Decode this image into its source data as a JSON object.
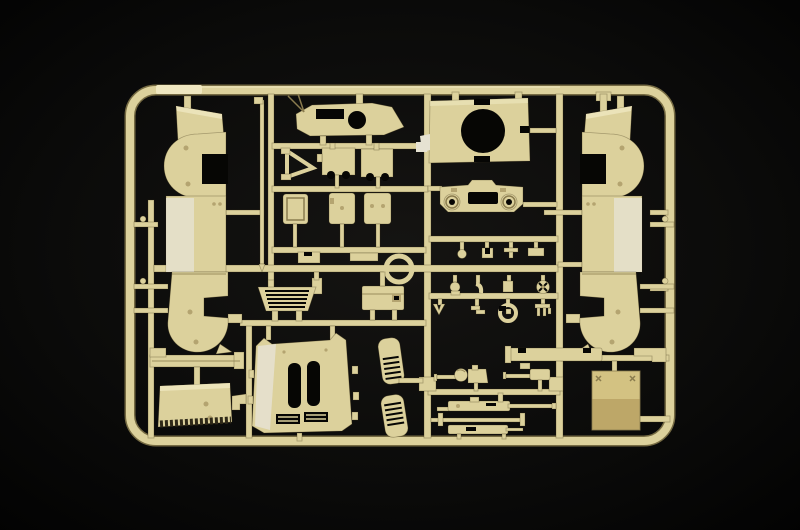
{
  "image": {
    "description": "Product photograph of a tan injection-moulded plastic model kit sprue (parts tree) lying on a black background",
    "subject": "model-kit-sprue",
    "parts": [
      "left hull side panel with fender arches",
      "right hull side panel with fender arches (mirror)",
      "roof plate with circular opening and antenna wire",
      "triangular support frame",
      "two notched mudguard panels",
      "three crew hatches",
      "long thin rod",
      "turret ring deck plate with large round opening",
      "front plate with two round bosses and vision slot",
      "ring / hatch collar",
      "stowage box",
      "ribbed engine louvre",
      "small fittings: balls, clips, hooks, spoked wheel, clamp ring, trident bracket",
      "upper glacis plate with two hatch slots and twin vent grilles",
      "two slatted vent grilles",
      "two ball-mount machine guns",
      "two long machine gun assemblies and axle rod",
      "fender plank",
      "panel with serrated dark edge",
      "long channel bar",
      "corner bracket",
      "large access plate"
    ]
  },
  "colors": {
    "bg-center": "#151412",
    "bg-mid": "#0b0b0a",
    "bg-edge": "#010101",
    "sprue": "#dcd19c",
    "sprue-light": "#efe7c0",
    "sprue-white": "#e6e2d2",
    "sprue-dark": "#b4a470",
    "sprue-deep": "#8a7c4e",
    "hole": "#060604",
    "serration": "#2f2918",
    "plate-top": "#d3c282",
    "plate-bottom": "#bda768"
  }
}
